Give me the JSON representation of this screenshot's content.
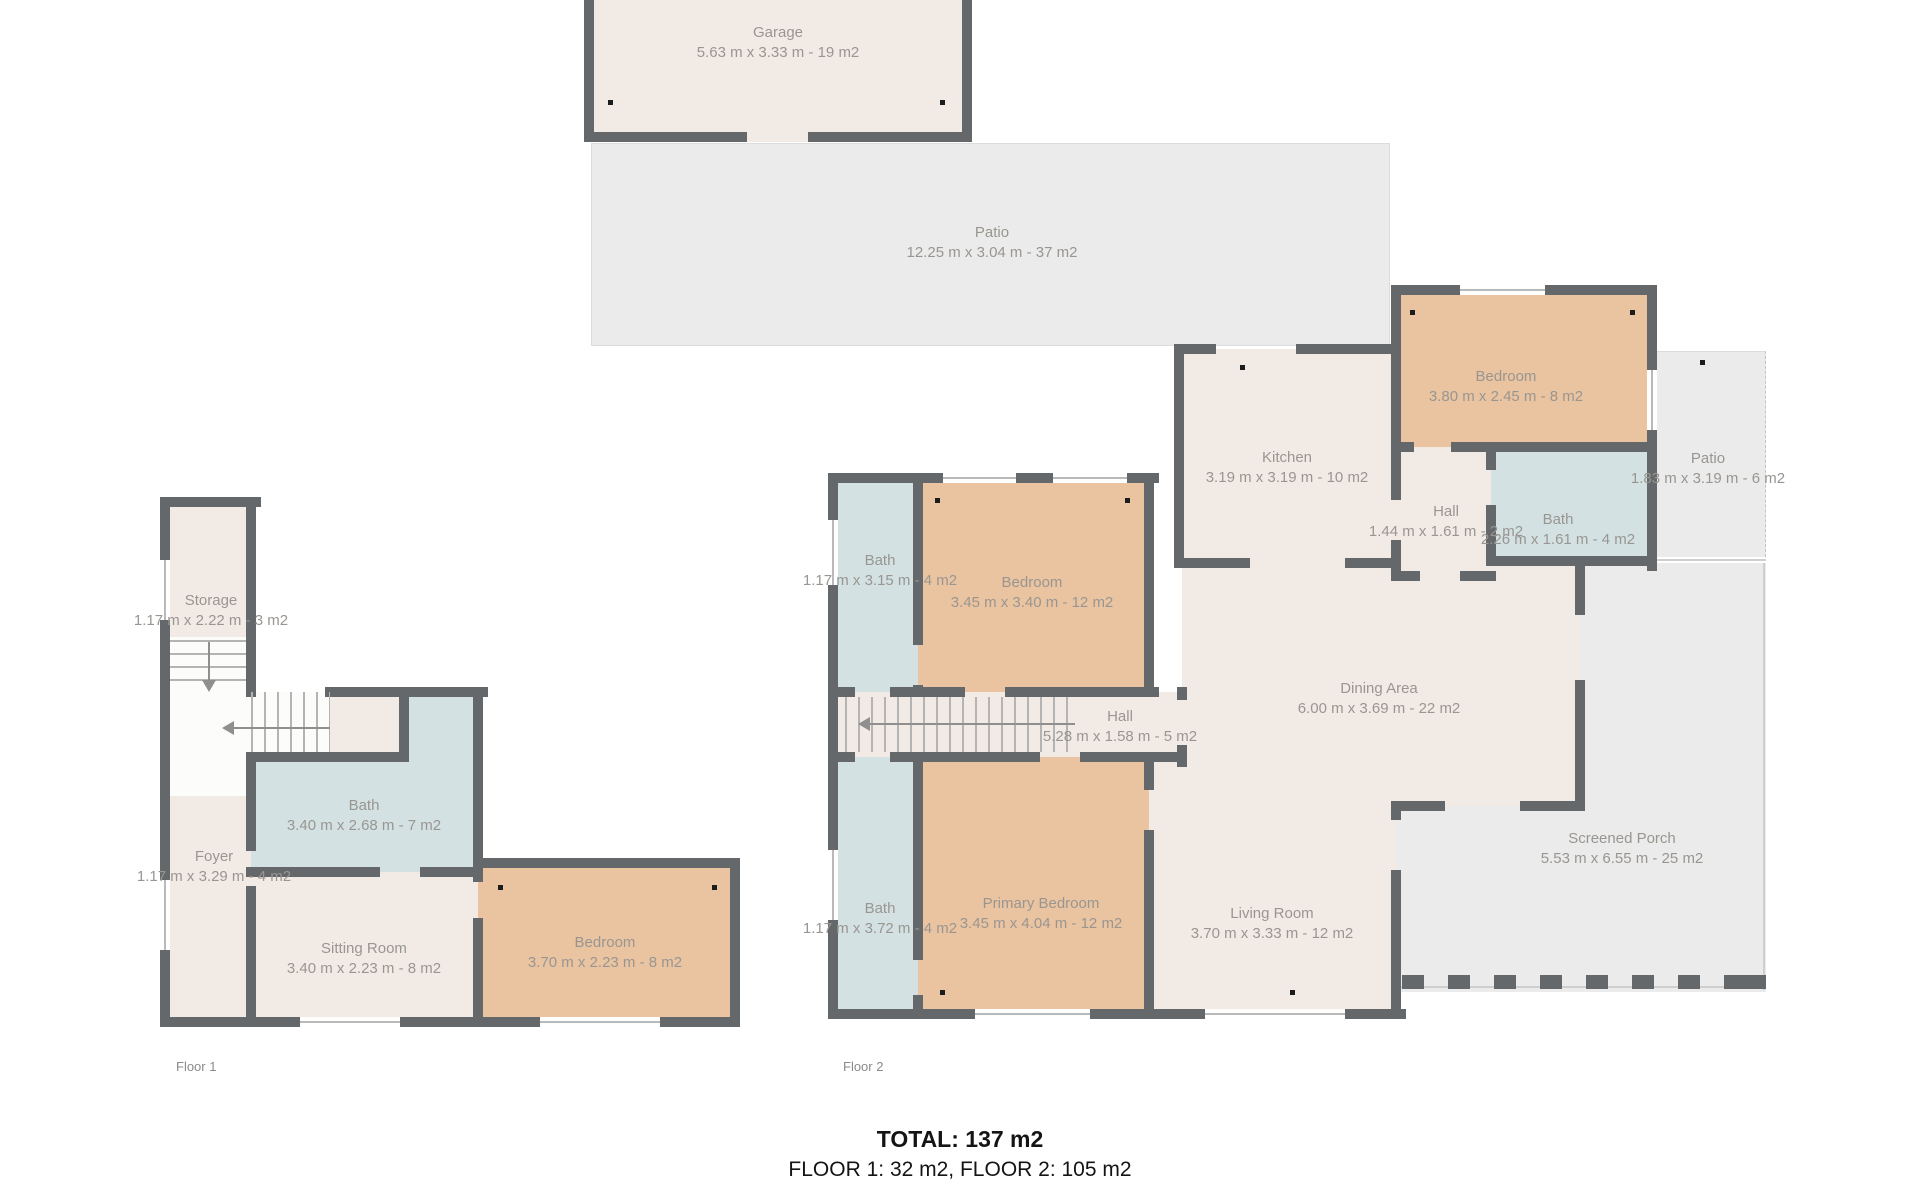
{
  "palette": {
    "wall": "#64686b",
    "interior_room": "#f2ebe5",
    "outdoor_area": "#ebebeb",
    "bedroom": "#eac3a0",
    "bathroom": "#d3e1e2",
    "label_text": "#999691",
    "summary_text": "#141414"
  },
  "floor1": {
    "label": "Floor 1",
    "rooms": [
      {
        "name": "Storage",
        "dims": "1.17 m x 2.22 m - 3 m2"
      },
      {
        "name": "Foyer",
        "dims": "1.17 m x 3.29 m - 4 m2"
      },
      {
        "name": "Bath",
        "dims": "3.40 m x 2.68 m - 7 m2"
      },
      {
        "name": "Sitting Room",
        "dims": "3.40 m x 2.23 m - 8 m2"
      },
      {
        "name": "Bedroom",
        "dims": "3.70 m x 2.23 m - 8 m2"
      }
    ]
  },
  "floor2": {
    "label": "Floor 2",
    "rooms": [
      {
        "name": "Garage",
        "dims": "5.63 m x 3.33 m - 19 m2"
      },
      {
        "name": "Patio",
        "dims": "12.25 m x 3.04 m - 37 m2"
      },
      {
        "name": "Bedroom",
        "dims": "3.80 m x 2.45 m - 8 m2"
      },
      {
        "name": "Kitchen",
        "dims": "3.19 m x 3.19 m - 10 m2"
      },
      {
        "name": "Hall",
        "dims": "1.44 m x 1.61 m - 2 m2"
      },
      {
        "name": "Bath",
        "dims": "2.26 m x 1.61 m - 4 m2"
      },
      {
        "name": "Patio",
        "dims": "1.83 m x 3.19 m - 6 m2"
      },
      {
        "name": "Bath",
        "dims": "1.17 m x 3.15 m - 4 m2"
      },
      {
        "name": "Bedroom",
        "dims": "3.45 m x 3.40 m - 12 m2"
      },
      {
        "name": "Hall",
        "dims": "5.28 m x 1.58 m - 5 m2"
      },
      {
        "name": "Dining Area",
        "dims": "6.00 m x 3.69 m - 22 m2"
      },
      {
        "name": "Bath",
        "dims": "1.17 m x 3.72 m - 4 m2"
      },
      {
        "name": "Primary Bedroom",
        "dims": "3.45 m x 4.04 m - 12 m2"
      },
      {
        "name": "Living Room",
        "dims": "3.70 m x 3.33 m - 12 m2"
      },
      {
        "name": "Screened Porch",
        "dims": "5.53 m x 6.55 m - 25 m2"
      }
    ]
  },
  "summary": {
    "total": "TOTAL: 137 m2",
    "floors": "FLOOR 1: 32 m2, FLOOR 2: 105 m2"
  }
}
